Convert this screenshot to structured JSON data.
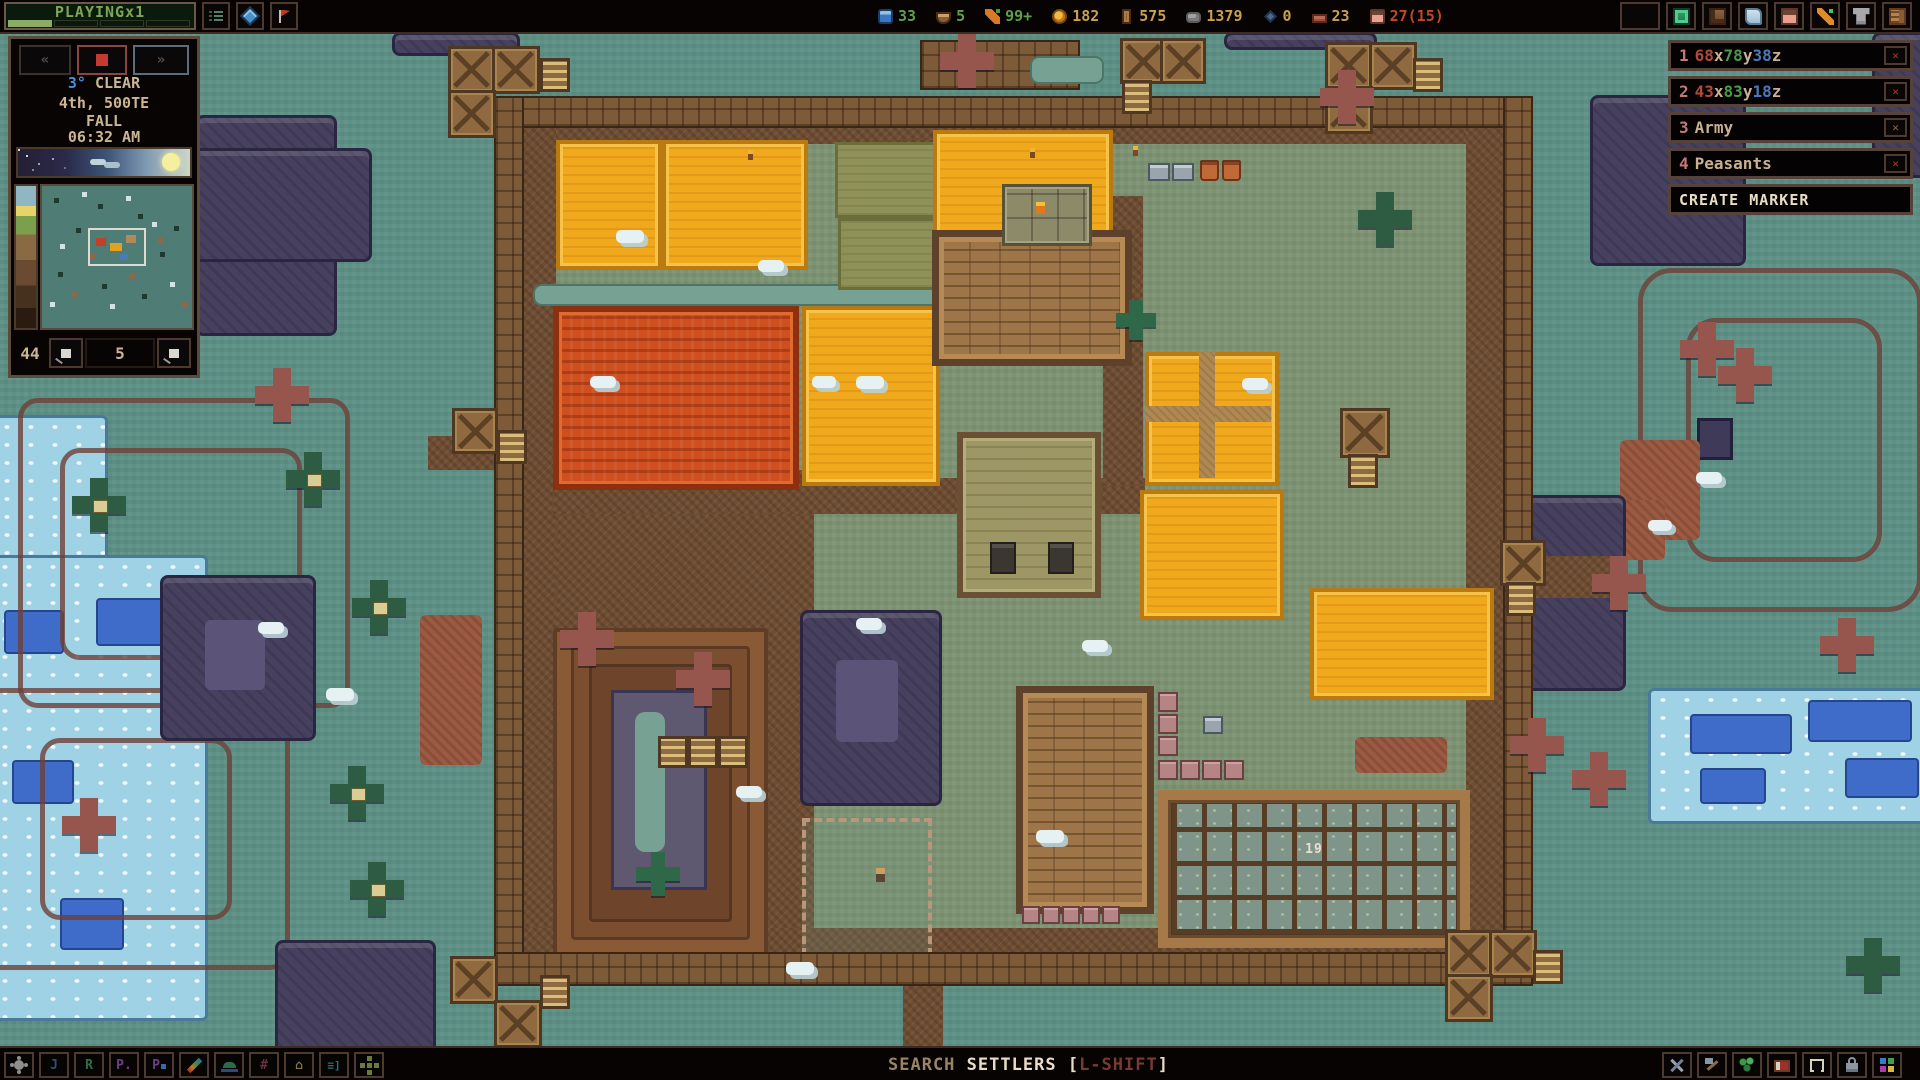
{
  "top_bar": {
    "playing_label": "PLAYINGx1",
    "menu_icons": [
      "list-icon",
      "gem-icon",
      "flag-icon"
    ],
    "resources": [
      {
        "name": "water",
        "value": "33",
        "color": "#5fa04a"
      },
      {
        "name": "meals",
        "value": "5",
        "color": "#5fa04a"
      },
      {
        "name": "crops",
        "value": "99+",
        "color": "#5fa04a"
      },
      {
        "name": "amber",
        "value": "182",
        "color": "#c8a050"
      },
      {
        "name": "wood",
        "value": "575",
        "color": "#c8a050"
      },
      {
        "name": "stone",
        "value": "1379",
        "color": "#c8a050"
      },
      {
        "name": "gems",
        "value": "0",
        "color": "#c8a050"
      },
      {
        "name": "blocks",
        "value": "23",
        "color": "#c8a050"
      },
      {
        "name": "settlers",
        "value": "27(15)",
        "color": "#c04828"
      }
    ],
    "right_icons": [
      "blank",
      "tome-icon",
      "kiln-icon",
      "scroll-icon",
      "settler-icon",
      "wand-icon",
      "armor-icon",
      "journal-icon"
    ]
  },
  "time_panel": {
    "rewind_label": "«",
    "forward_label": "»",
    "temperature": "3°",
    "weather": "CLEAR",
    "date_line": "4th, 500TE",
    "season": "FALL",
    "clock": "06:32 AM",
    "depth_value": "44",
    "marker_value": "5"
  },
  "markers": {
    "rows": [
      {
        "n": "1",
        "x": "68",
        "xu": "x",
        "y": "78",
        "yu": "y",
        "z": "38",
        "zu": "z",
        "label": ""
      },
      {
        "n": "2",
        "x": "43",
        "xu": "x",
        "y": "83",
        "yu": "y",
        "z": "18",
        "zu": "z",
        "label": ""
      },
      {
        "n": "3",
        "label": "Army"
      },
      {
        "n": "4",
        "label": "Peasants"
      }
    ],
    "delete_glyph": "✕",
    "create_label": "CREATE MARKER"
  },
  "bottom_bar": {
    "left_tools": [
      {
        "name": "gear-tool",
        "glyph": ""
      },
      {
        "name": "jobs-tool",
        "glyph": "J"
      },
      {
        "name": "rooms-tool",
        "glyph": "R"
      },
      {
        "name": "priority-tool",
        "glyph": "P."
      },
      {
        "name": "zones-tool",
        "glyph": "P"
      },
      {
        "name": "paint-tool",
        "glyph": ""
      },
      {
        "name": "outfit-tool",
        "glyph": ""
      },
      {
        "name": "grid-tool",
        "glyph": "#"
      },
      {
        "name": "home-tool",
        "glyph": "⌂"
      },
      {
        "name": "list-tool",
        "glyph": "≡]"
      },
      {
        "name": "pattern-tool",
        "glyph": ""
      }
    ],
    "search_word1": "SEARCH",
    "search_word2": "SETTLERS",
    "bracket_open": "[",
    "search_hotkey": "L-SHIFT",
    "bracket_close": "]",
    "right_tools": [
      "tools-icon",
      "hammer-icon",
      "plant-icon",
      "bed-icon",
      "frame-icon",
      "lock-icon",
      "palette-icon"
    ]
  },
  "map": {
    "stockpile_count": "19"
  }
}
